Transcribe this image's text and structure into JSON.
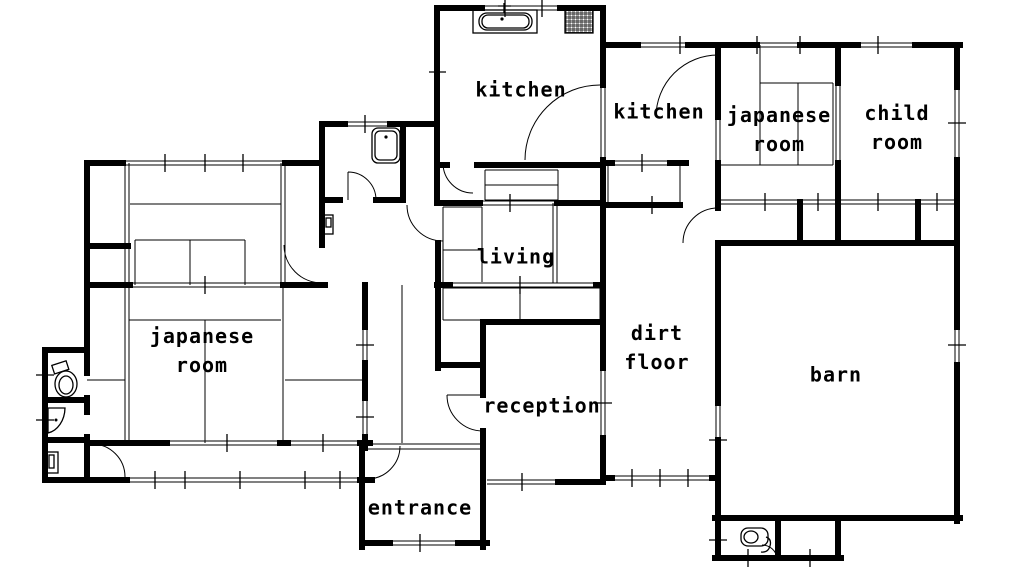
{
  "figure_type": "house floor plan",
  "floorplan": {
    "colors": {
      "background": "#ffffff",
      "line": "#000000",
      "text": "#000000"
    },
    "rooms": {
      "kitchen_main": {
        "label": "kitchen"
      },
      "kitchen_secondary": {
        "label": "kitchen"
      },
      "japanese_room_upper": {
        "label": "japanese room"
      },
      "child_room": {
        "label": "child room"
      },
      "living": {
        "label": "living"
      },
      "dirt_floor": {
        "label": "dirt floor"
      },
      "barn": {
        "label": "barn"
      },
      "reception": {
        "label": "reception"
      },
      "japanese_room_left": {
        "label": "japanese room"
      },
      "entrance": {
        "label": "entrance"
      }
    },
    "fixtures": [
      {
        "name": "bathtub",
        "room": "kitchen_main"
      },
      {
        "name": "gas-stove",
        "room": "kitchen_main"
      },
      {
        "name": "wash-basin",
        "room": "washroom"
      },
      {
        "name": "water-heater",
        "room": "hallway"
      },
      {
        "name": "toilet",
        "room": "left-annex"
      },
      {
        "name": "corner-basin",
        "room": "left-annex"
      },
      {
        "name": "shoe-cabinet",
        "room": "left-annex"
      },
      {
        "name": "toilet",
        "room": "barn-annex"
      }
    ]
  }
}
